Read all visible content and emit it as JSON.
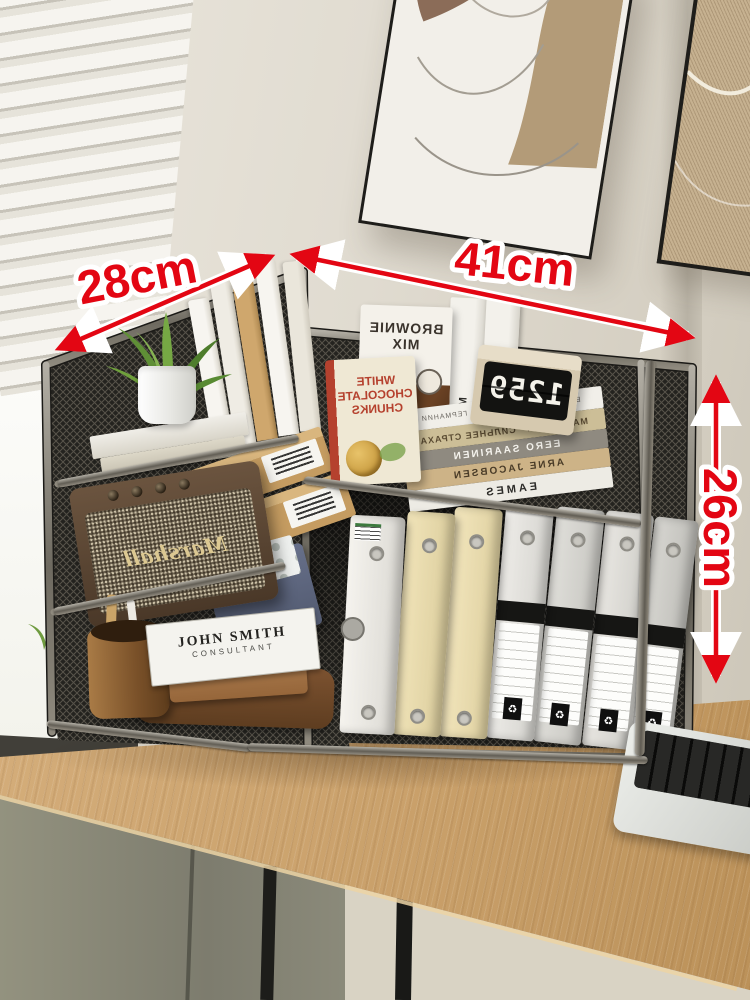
{
  "annotations": {
    "depth": "28cm",
    "width": "41cm",
    "height": "26cm",
    "arrow_color": "#e30613"
  },
  "colors": {
    "wall": "#e0dbd0",
    "desk_wood": "#c9a06a",
    "mesh": "#24231f",
    "cabinet": "#87866f"
  },
  "shelf_items": {
    "flip_clock": {
      "time": "1259"
    },
    "brownie_box": {
      "title": "BROWNIE MIX"
    },
    "chocolate_box": {
      "line1": "WHITE",
      "line2": "CHOCOLATE",
      "line3": "CHUNKS"
    },
    "mix_box_spine": "MIX",
    "book_stack": [
      {
        "title": "ВСЁ ЧТО НУЖНО ЗНАТЬ О ГЕРМАНИИ"
      },
      {
        "title": "СИЛЬНЕЕ СТРАХА",
        "author": "МАРК ЛЕВИ"
      },
      {
        "title": "EERO SAARINEN"
      },
      {
        "title": "ARNE JACOBSEN"
      },
      {
        "title": "EAMES"
      }
    ],
    "speaker": {
      "brand": "Marshall"
    },
    "business_card": {
      "name": "JOHN SMITH",
      "role": "CONSULTANT"
    },
    "binder_recycle_symbol": "♻"
  }
}
